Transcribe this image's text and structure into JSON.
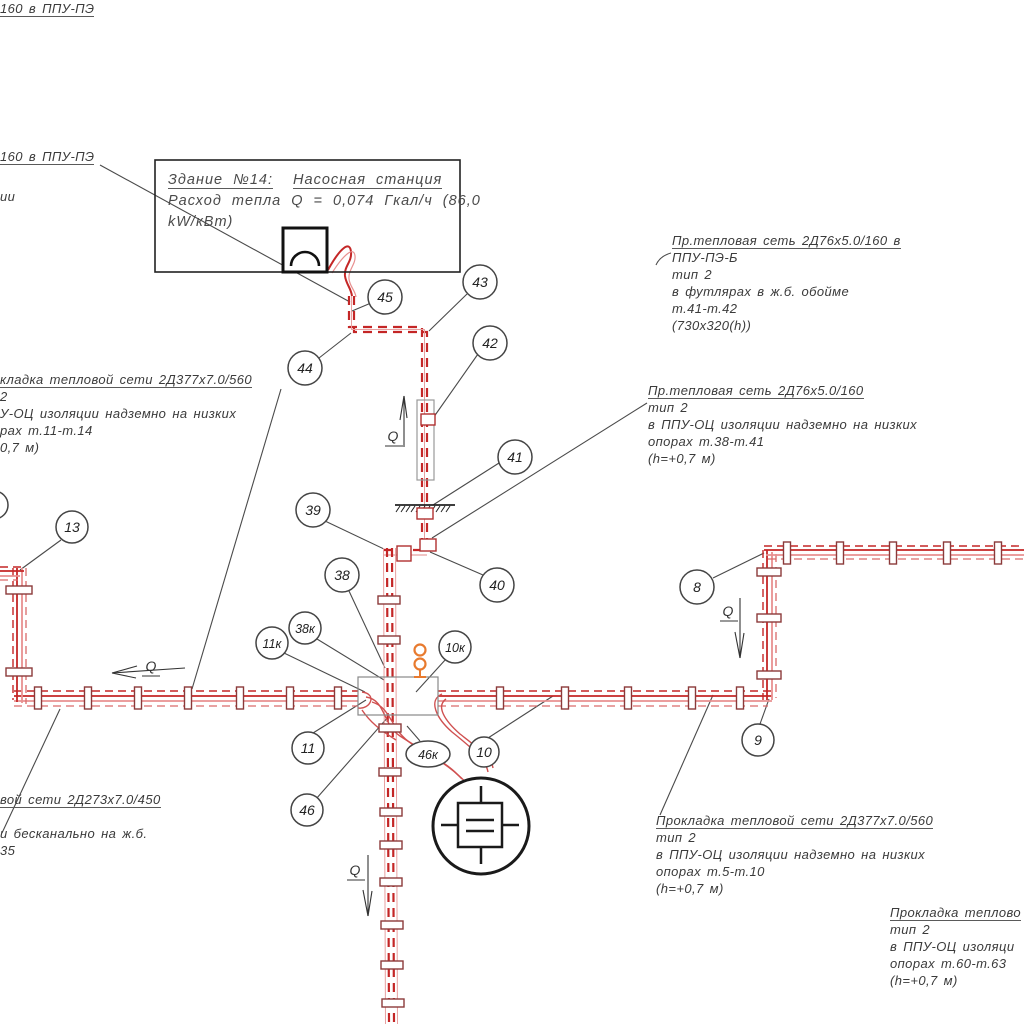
{
  "building": {
    "title": "Здание №14:",
    "title2": "Насосная станция",
    "line2": "Расход тепла Q = 0,074 Гкал/ч (86,0",
    "line3": "kW/кВт)"
  },
  "annotations": {
    "top_left": {
      "line1": "160 в ППУ-ПЭ",
      "line2": "ии"
    },
    "left": {
      "lines": [
        "кладка тепловой сети 2Д377х7.0/560",
        "2",
        "У-ОЦ изоляции надземно на низких",
        "рах т.11-т.14",
        "0,7 м)"
      ]
    },
    "right1": {
      "lines": [
        "Пр.тепловая сеть 2Д76х5.0/160 в",
        "ППУ-ПЭ-Б",
        "тип 2",
        "в футлярах в ж.б. обойме",
        "т.41-т.42",
        "(730х320(h))"
      ]
    },
    "right2": {
      "lines": [
        "Пр.тепловая сеть 2Д76х5.0/160",
        "тип 2",
        "в ППУ-ОЦ изоляции надземно на низких",
        "опорах т.38-т.41",
        "(h=+0,7 м)"
      ]
    },
    "bottom_left": {
      "lines": [
        "вой сети 2Д273х7.0/450",
        "",
        "и бесканально на ж.б.",
        "35"
      ]
    },
    "bottom_right1": {
      "lines": [
        "Прокладка тепловой сети 2Д377х7.0/560",
        "тип 2",
        "в ППУ-ОЦ изоляции надземно на низких",
        "опорах т.5-т.10",
        "(h=+0,7 м)"
      ]
    },
    "bottom_right2": {
      "lines": [
        "Прокладка теплово",
        "тип 2",
        "в ППУ-ОЦ изоляци",
        "опорах т.60-т.63",
        "(h=+0,7 м)"
      ]
    }
  },
  "nodes": [
    "45",
    "43",
    "44",
    "42",
    "41",
    "39",
    "40",
    "38",
    "38к",
    "11к",
    "10к",
    "13",
    "8",
    "9",
    "11",
    "10",
    "46к",
    "46"
  ],
  "flow": {
    "q": "Q"
  },
  "colors": {
    "pipe_dark": "#c42626",
    "pipe_light": "#e89090",
    "leader": "#4a4a4a",
    "orange": "#e87a2e",
    "casing_gray": "#999999",
    "symbol_black": "#1a1a1a"
  }
}
